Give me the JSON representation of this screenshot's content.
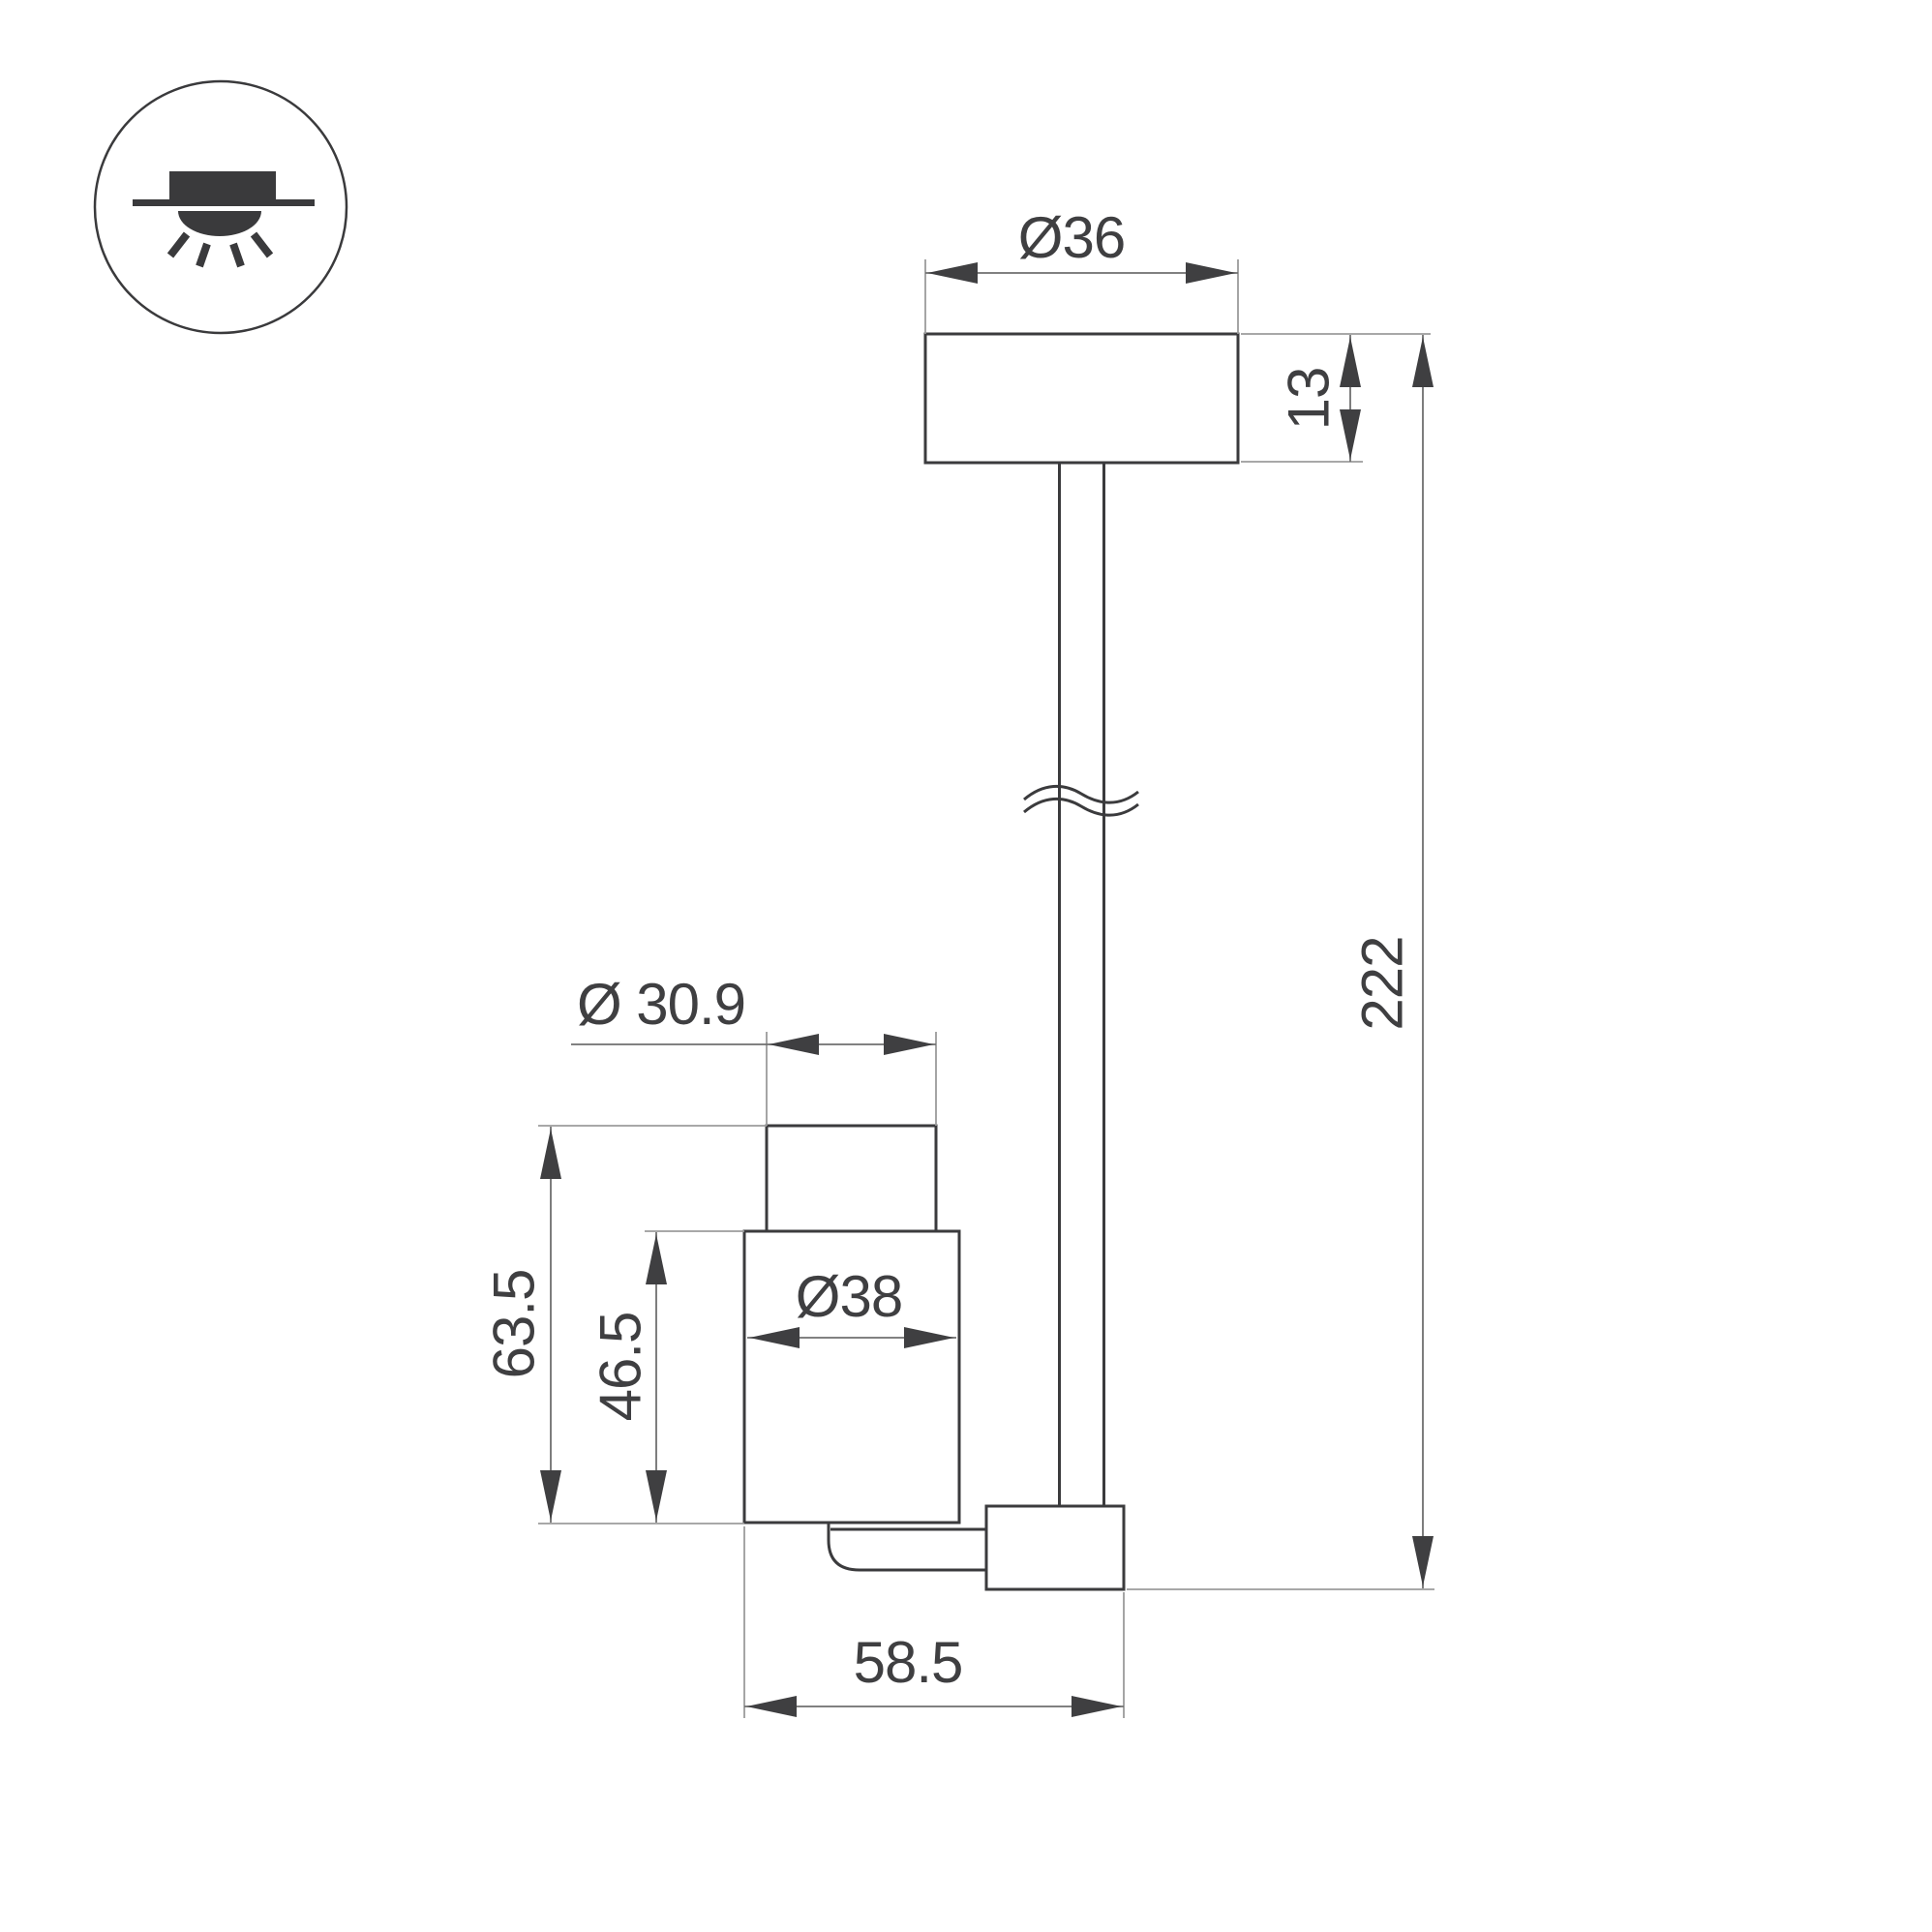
{
  "drawing": {
    "type": "technical-dimension-drawing",
    "subject": "ceiling surface-mounted rod spotlight",
    "colors": {
      "background": "#ffffff",
      "object_line": "#3b3b3d",
      "dimension_line": "#6f6f6f",
      "extension_line": "#9b9b9b",
      "text": "#3f3f41"
    }
  },
  "dimensions": {
    "canopy_diameter": "Ø36",
    "canopy_height": "13",
    "overall_length": "222",
    "head_top_diameter": "Ø 30.9",
    "head_body_diameter": "Ø38",
    "head_total_height": "63.5",
    "head_body_height": "46.5",
    "base_length": "58.5"
  }
}
